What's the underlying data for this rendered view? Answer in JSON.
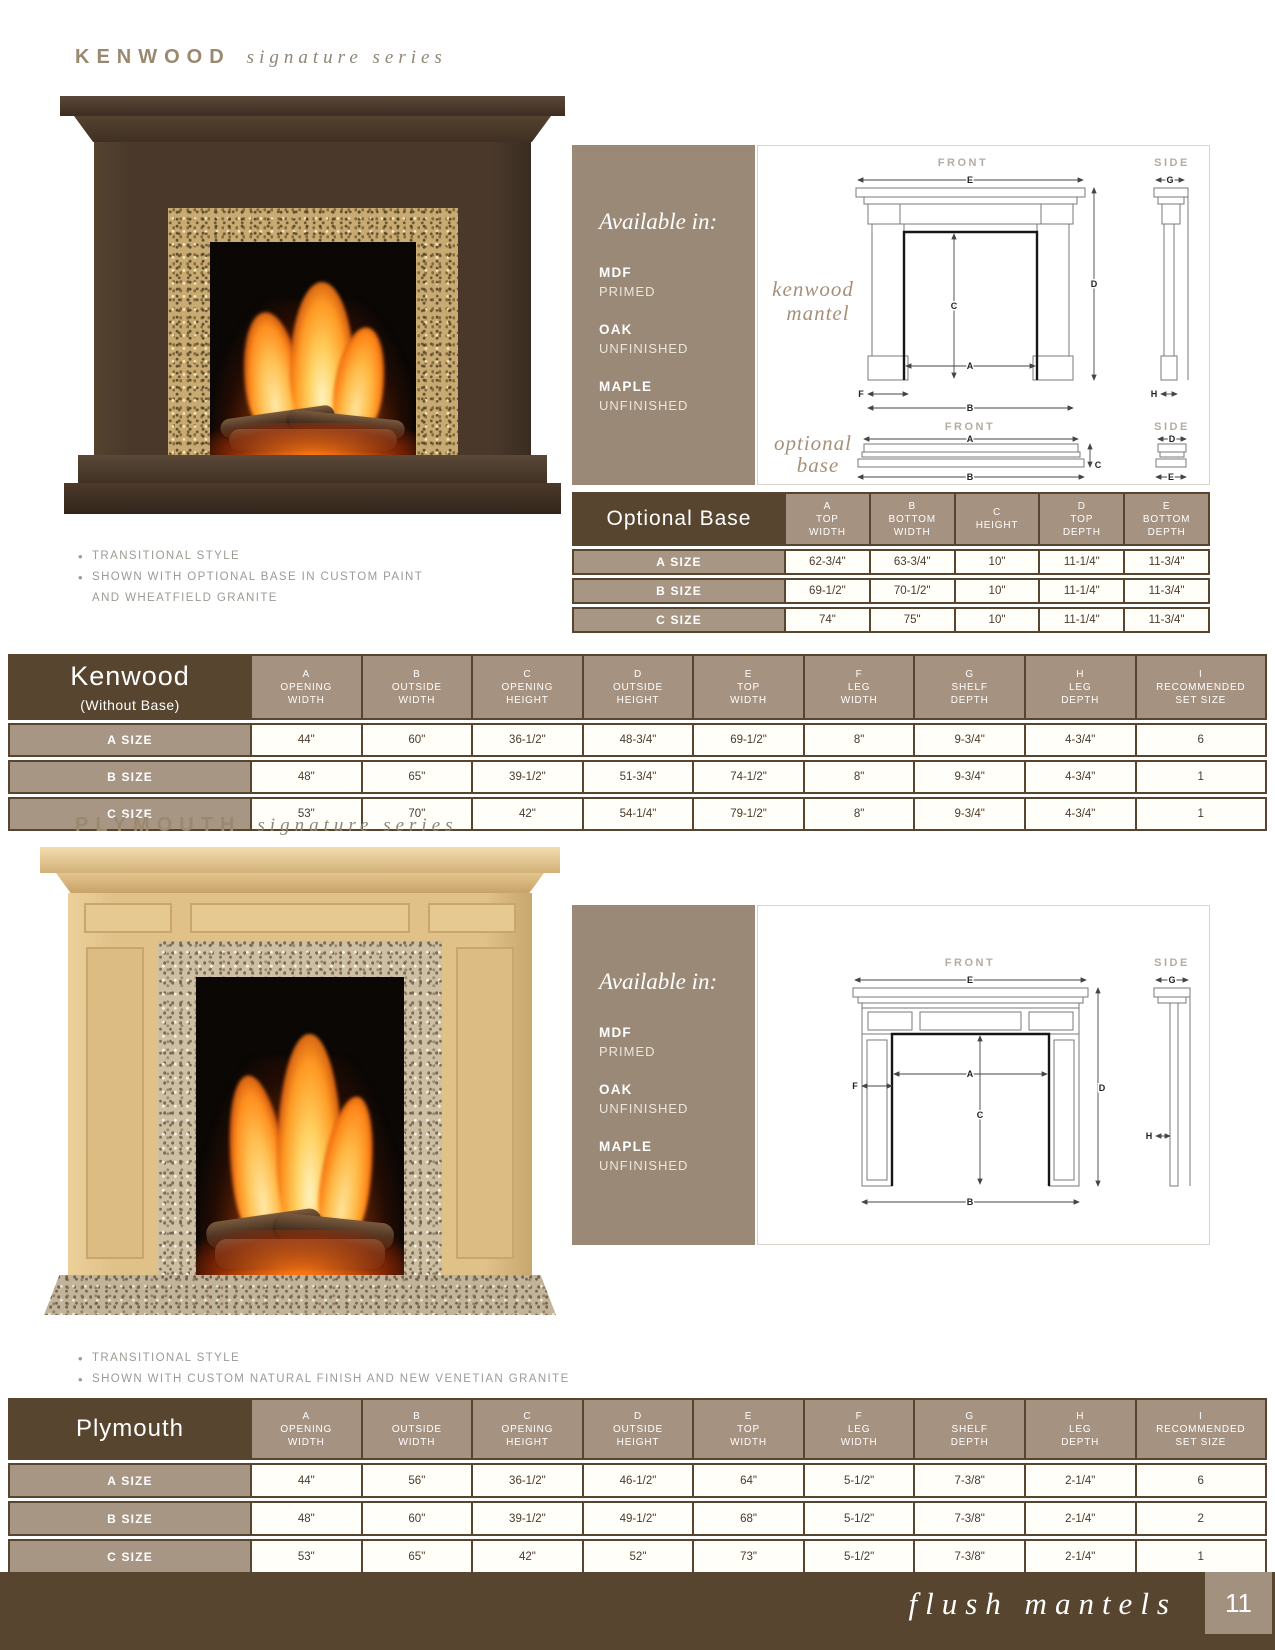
{
  "page": {
    "footer_label": "flush mantels",
    "page_number": "11"
  },
  "colors": {
    "dark_brown": "#57452F",
    "taupe_panel": "#9A8977",
    "header_cell_taupe": "#A59281",
    "row_label_taupe": "#A89684"
  },
  "kenwood": {
    "title": "KENWOOD",
    "series": "signature series",
    "available": {
      "heading": "Available in:",
      "options": [
        {
          "name": "MDF",
          "finish": "PRIMED"
        },
        {
          "name": "OAK",
          "finish": "UNFINISHED"
        },
        {
          "name": "MAPLE",
          "finish": "UNFINISHED"
        }
      ]
    },
    "bullets": [
      "TRANSITIONAL STYLE",
      "SHOWN WITH OPTIONAL BASE IN CUSTOM PAINT"
    ],
    "bullet_continuation": "AND WHEATFIELD GRANITE",
    "diagram": {
      "front_label": "FRONT",
      "side_label": "SIDE",
      "caption_line1": "kenwood",
      "caption_line2": "mantel",
      "base_front_label": "FRONT",
      "base_side_label": "SIDE",
      "base_caption_line1": "optional",
      "base_caption_line2": "base",
      "dims": {
        "a": "A",
        "b": "B",
        "c": "C",
        "d": "D",
        "e": "E",
        "f": "F",
        "g": "G",
        "h": "H"
      },
      "base_dims": {
        "a": "A",
        "b": "B",
        "c": "C",
        "d": "D",
        "e": "E"
      }
    }
  },
  "optional_base_table": {
    "title": "Optional Base",
    "columns": [
      {
        "letter": "A",
        "label": "TOP\nWIDTH"
      },
      {
        "letter": "B",
        "label": "BOTTOM\nWIDTH"
      },
      {
        "letter": "C",
        "label": "HEIGHT"
      },
      {
        "letter": "D",
        "label": "TOP\nDEPTH"
      },
      {
        "letter": "E",
        "label": "BOTTOM\nDEPTH"
      }
    ],
    "rows": [
      {
        "label": "A SIZE",
        "cells": [
          "62-3/4\"",
          "63-3/4\"",
          "10\"",
          "11-1/4\"",
          "11-3/4\""
        ]
      },
      {
        "label": "B SIZE",
        "cells": [
          "69-1/2\"",
          "70-1/2\"",
          "10\"",
          "11-1/4\"",
          "11-3/4\""
        ]
      },
      {
        "label": "C SIZE",
        "cells": [
          "74\"",
          "75\"",
          "10\"",
          "11-1/4\"",
          "11-3/4\""
        ]
      }
    ]
  },
  "kenwood_table": {
    "title": "Kenwood",
    "subtitle": "(Without Base)",
    "columns": [
      {
        "letter": "A",
        "label": "OPENING\nWIDTH"
      },
      {
        "letter": "B",
        "label": "OUTSIDE\nWIDTH"
      },
      {
        "letter": "C",
        "label": "OPENING\nHEIGHT"
      },
      {
        "letter": "D",
        "label": "OUTSIDE\nHEIGHT"
      },
      {
        "letter": "E",
        "label": "TOP\nWIDTH"
      },
      {
        "letter": "F",
        "label": "LEG\nWIDTH"
      },
      {
        "letter": "G",
        "label": "SHELF\nDEPTH"
      },
      {
        "letter": "H",
        "label": "LEG\nDEPTH"
      },
      {
        "letter": "I",
        "label": "RECOMMENDED\nSET SIZE"
      }
    ],
    "rows": [
      {
        "label": "A SIZE",
        "cells": [
          "44\"",
          "60\"",
          "36-1/2\"",
          "48-3/4\"",
          "69-1/2\"",
          "8\"",
          "9-3/4\"",
          "4-3/4\"",
          "6"
        ]
      },
      {
        "label": "B SIZE",
        "cells": [
          "48\"",
          "65\"",
          "39-1/2\"",
          "51-3/4\"",
          "74-1/2\"",
          "8\"",
          "9-3/4\"",
          "4-3/4\"",
          "1"
        ]
      },
      {
        "label": "C SIZE",
        "cells": [
          "53\"",
          "70\"",
          "42\"",
          "54-1/4\"",
          "79-1/2\"",
          "8\"",
          "9-3/4\"",
          "4-3/4\"",
          "1"
        ]
      }
    ]
  },
  "plymouth": {
    "title": "PLYMOUTH",
    "series": "signature series",
    "available": {
      "heading": "Available in:",
      "options": [
        {
          "name": "MDF",
          "finish": "PRIMED"
        },
        {
          "name": "OAK",
          "finish": "UNFINISHED"
        },
        {
          "name": "MAPLE",
          "finish": "UNFINISHED"
        }
      ]
    },
    "bullets": [
      "TRANSITIONAL STYLE",
      "SHOWN WITH CUSTOM NATURAL FINISH AND NEW VENETIAN GRANITE"
    ],
    "diagram": {
      "front_label": "FRONT",
      "side_label": "SIDE",
      "dims": {
        "a": "A",
        "b": "B",
        "c": "C",
        "d": "D",
        "e": "E",
        "f": "F",
        "g": "G",
        "h": "H"
      }
    }
  },
  "plymouth_table": {
    "title": "Plymouth",
    "columns": [
      {
        "letter": "A",
        "label": "OPENING\nWIDTH"
      },
      {
        "letter": "B",
        "label": "OUTSIDE\nWIDTH"
      },
      {
        "letter": "C",
        "label": "OPENING\nHEIGHT"
      },
      {
        "letter": "D",
        "label": "OUTSIDE\nHEIGHT"
      },
      {
        "letter": "E",
        "label": "TOP\nWIDTH"
      },
      {
        "letter": "F",
        "label": "LEG\nWIDTH"
      },
      {
        "letter": "G",
        "label": "SHELF\nDEPTH"
      },
      {
        "letter": "H",
        "label": "LEG\nDEPTH"
      },
      {
        "letter": "I",
        "label": "RECOMMENDED\nSET SIZE"
      }
    ],
    "rows": [
      {
        "label": "A SIZE",
        "cells": [
          "44\"",
          "56\"",
          "36-1/2\"",
          "46-1/2\"",
          "64\"",
          "5-1/2\"",
          "7-3/8\"",
          "2-1/4\"",
          "6"
        ]
      },
      {
        "label": "B SIZE",
        "cells": [
          "48\"",
          "60\"",
          "39-1/2\"",
          "49-1/2\"",
          "68\"",
          "5-1/2\"",
          "7-3/8\"",
          "2-1/4\"",
          "2"
        ]
      },
      {
        "label": "C SIZE",
        "cells": [
          "53\"",
          "65\"",
          "42\"",
          "52\"",
          "73\"",
          "5-1/2\"",
          "7-3/8\"",
          "2-1/4\"",
          "1"
        ]
      }
    ]
  }
}
